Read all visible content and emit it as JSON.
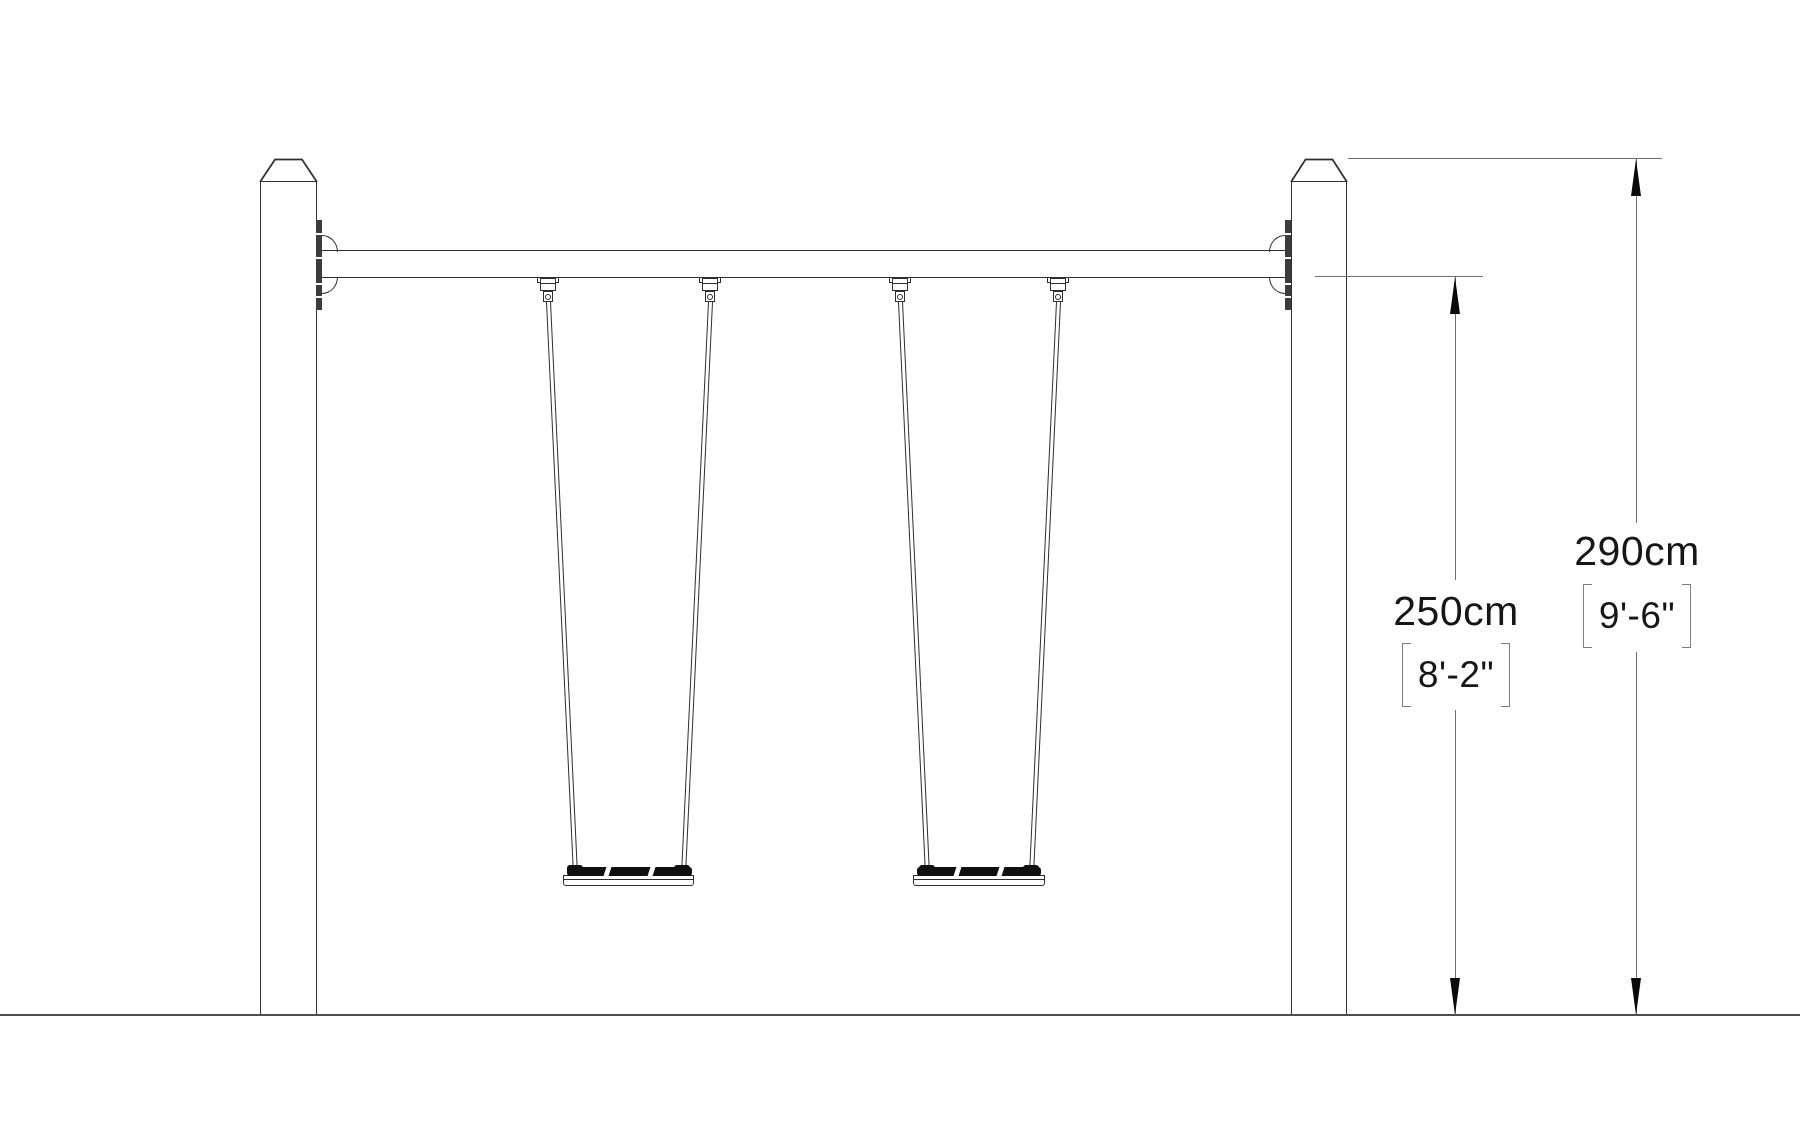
{
  "document": {
    "type": "technical elevation drawing",
    "subject": "double flat-seat swing set"
  },
  "dimensions": {
    "hanger_height": {
      "metric": "250cm",
      "imperial": "8'-2\""
    },
    "overall_height": {
      "metric": "290cm",
      "imperial": "9'-6\""
    }
  },
  "colors": {
    "outline": "#2e2e2e",
    "dim-line": "#6f6f6f",
    "arrow": "#0a0a0a",
    "ground": "#4c4c4c",
    "text": "#161616",
    "seat": "#101010"
  }
}
